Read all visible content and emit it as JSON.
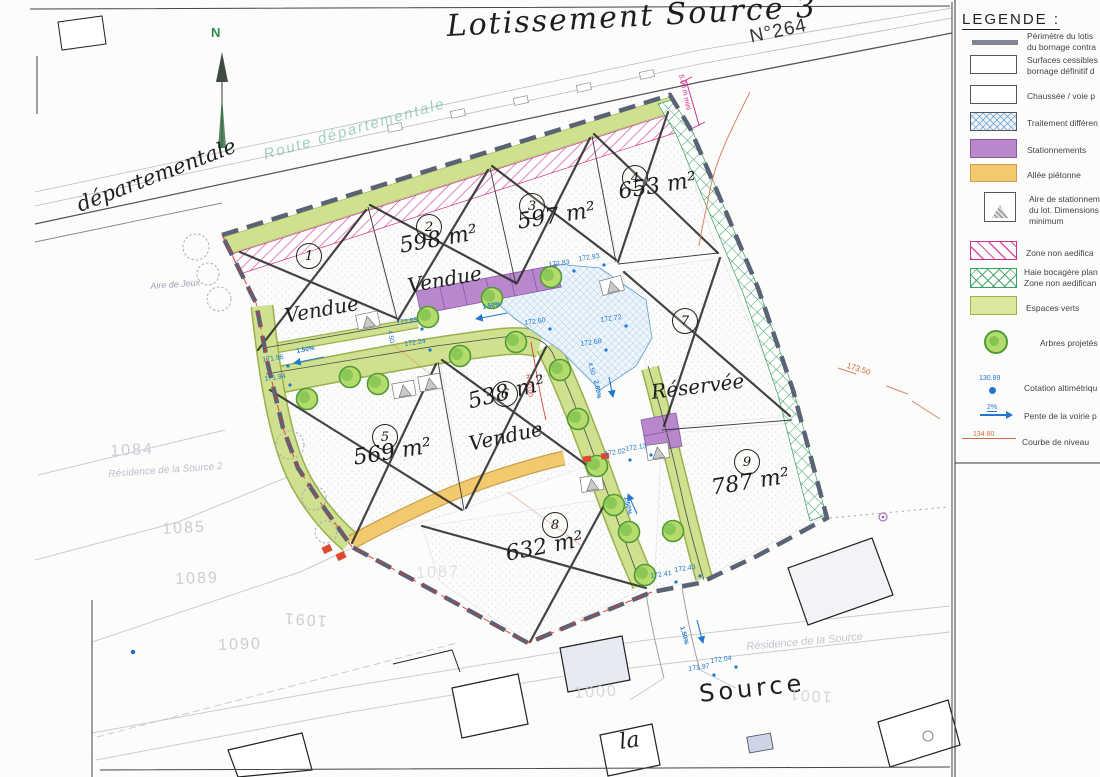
{
  "sheet": {
    "title": "Lotissement Source 3",
    "road_number": "N°264",
    "north": "N"
  },
  "streets": {
    "departementale": "départementale",
    "route_departementale": "Route départementale",
    "la": "la",
    "source": "Source"
  },
  "places": {
    "aire_de_jeux": "Aire de Jeux",
    "residence_2": "Résidence de la Source 2",
    "residence_1": "Résidence de la Source"
  },
  "lots": [
    {
      "num": "1",
      "area": "",
      "status": "Vendue"
    },
    {
      "num": "2",
      "area": "598 m²",
      "status": "Vendue"
    },
    {
      "num": "3",
      "area": "597 m²",
      "status": ""
    },
    {
      "num": "4",
      "area": "653 m²",
      "status": ""
    },
    {
      "num": "5",
      "area": "569 m²",
      "status": ""
    },
    {
      "num": "6",
      "area": "538 m²",
      "status": "Vendue"
    },
    {
      "num": "7",
      "area": "",
      "status": "Réservée"
    },
    {
      "num": "8",
      "area": "632 m²",
      "status": ""
    },
    {
      "num": "9",
      "area": "787 m²",
      "status": ""
    }
  ],
  "parcels": [
    "1084",
    "1085",
    "1089",
    "1090",
    "1091",
    "1087",
    "1000",
    "1001"
  ],
  "elevations": [
    "171.96",
    "171.94",
    "172.85",
    "172.24",
    "172.83",
    "172.93",
    "172.60",
    "172.72",
    "172.68",
    "172.13",
    "172.02",
    "172.41",
    "172.43",
    "171.97",
    "172.04"
  ],
  "slopes": [
    "1.50%",
    "1.50%",
    "1.50%",
    "2.00%",
    "1.50%"
  ],
  "dims": {
    "min_width": "5.00 m mini",
    "radius": "R 10.00",
    "w1": "4.50",
    "w2": "4.50"
  },
  "contours": {
    "label": "173.50"
  },
  "palette": {
    "perimetre": "#5a6375",
    "espaces_verts": "#cfe08e",
    "stationnements": "#b887cc",
    "allee_pietonne": "#f2c96d",
    "haie_bocagere": "#3aa060",
    "zone_non_aedificandi": "#d94fa0",
    "traitement_differencie": "#9cc4e0",
    "cotation": "#2277cc",
    "courbe_niveau": "#cc6a45"
  },
  "legend": {
    "heading": "LEGENDE :",
    "items": [
      {
        "l1": "Périmètre du lotis",
        "l2": "du bornage contra"
      },
      {
        "l1": "Surfaces cessibles",
        "l2": "bornage définitif d"
      },
      {
        "l1": "Chaussée / voie p"
      },
      {
        "l1": "Traitement différen"
      },
      {
        "l1": "Stationnements"
      },
      {
        "l1": "Allée piétonne"
      },
      {
        "l1": "Aire de stationnem",
        "l2": "du lot. Dimensions",
        "l3": "minimum"
      },
      {
        "l1": "Zone non aedifica"
      },
      {
        "l1": "Haie bocagère plan",
        "l2": "Zone non aedifican"
      },
      {
        "l1": "Espaces verts"
      },
      {
        "l1": "Arbres projetés"
      },
      {
        "l1": "Cotation altimétriqu",
        "value": "130.89"
      },
      {
        "l1": "Pente de la voirie p",
        "value": "2%"
      },
      {
        "l1": "Courbe de niveau",
        "value": "134.80"
      }
    ]
  }
}
